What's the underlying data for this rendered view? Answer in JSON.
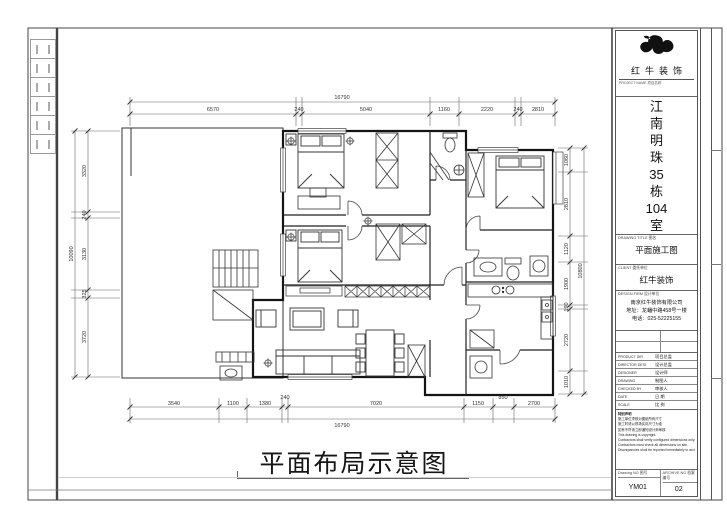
{
  "sheet": {
    "bottom_title": "平面布局示意图"
  },
  "dims": {
    "top": {
      "overall": "16790",
      "segments": [
        "6570",
        "240",
        "5040",
        "1160",
        "2220",
        "240",
        "2810"
      ]
    },
    "bottom": {
      "overall": "16790",
      "segments": [
        "3540",
        "1100",
        "1380",
        "240",
        "7020",
        "1150",
        "850",
        "2700"
      ]
    },
    "left": {
      "overall": "10090",
      "segments": [
        "3320",
        "240",
        "3130",
        "325",
        "3720"
      ]
    },
    "right": {
      "overall": "10800",
      "segments": [
        "1060",
        "2810",
        "1120",
        "1900",
        "190",
        "2720",
        "1010"
      ]
    }
  },
  "title_block": {
    "brand": "红牛装饰",
    "brand_sub": "PROJECT NAME 项目名称",
    "project_chars": [
      "江",
      "南",
      "明",
      "珠",
      "35",
      "栋",
      "104",
      "室"
    ],
    "sections": {
      "drawing_title": {
        "label": "DRAWING TITLE 图名",
        "value": "平面施工图"
      },
      "client": {
        "label": "CLIENT 委托单位",
        "value": "红牛装饰"
      },
      "design_firm": {
        "label": "DESIGN FIRM 设计单位",
        "lines": [
          "南京红牛装饰有限公司",
          "地址：龙蟠中路458号一楼",
          "电话：025-52225155"
        ]
      }
    },
    "personnel": [
      {
        "en": "PRODUCT DIR",
        "cn": "项目总监"
      },
      {
        "en": "DIRECTOR DESI",
        "cn": "设计总监"
      },
      {
        "en": "DESIGNER",
        "cn": "设计师"
      },
      {
        "en": "DRAWING",
        "cn": "制图人"
      },
      {
        "en": "CHECKED BY",
        "cn": "审核人"
      },
      {
        "en": "DATE",
        "cn": "日 期"
      },
      {
        "en": "SCALE",
        "cn": "比 例"
      }
    ],
    "notes": [
      "特别声明",
      "施工单位须核对图纸所有尺寸",
      "施工时请以现场实际尺寸为准",
      "如有不符请立即通知设计师审核",
      "This drawing is copyright.",
      "Contractors shall verify configured dimensions only.",
      "Contractors must check all dimensions on site.",
      "Discrepancies shall be reported immediately to architects."
    ],
    "bottom": {
      "drawing_no": {
        "label": "Drawing NO 图号",
        "value": "YM01"
      },
      "archive_no": {
        "label": "ARCHIVE NO 档案编号",
        "value": "02"
      }
    }
  }
}
